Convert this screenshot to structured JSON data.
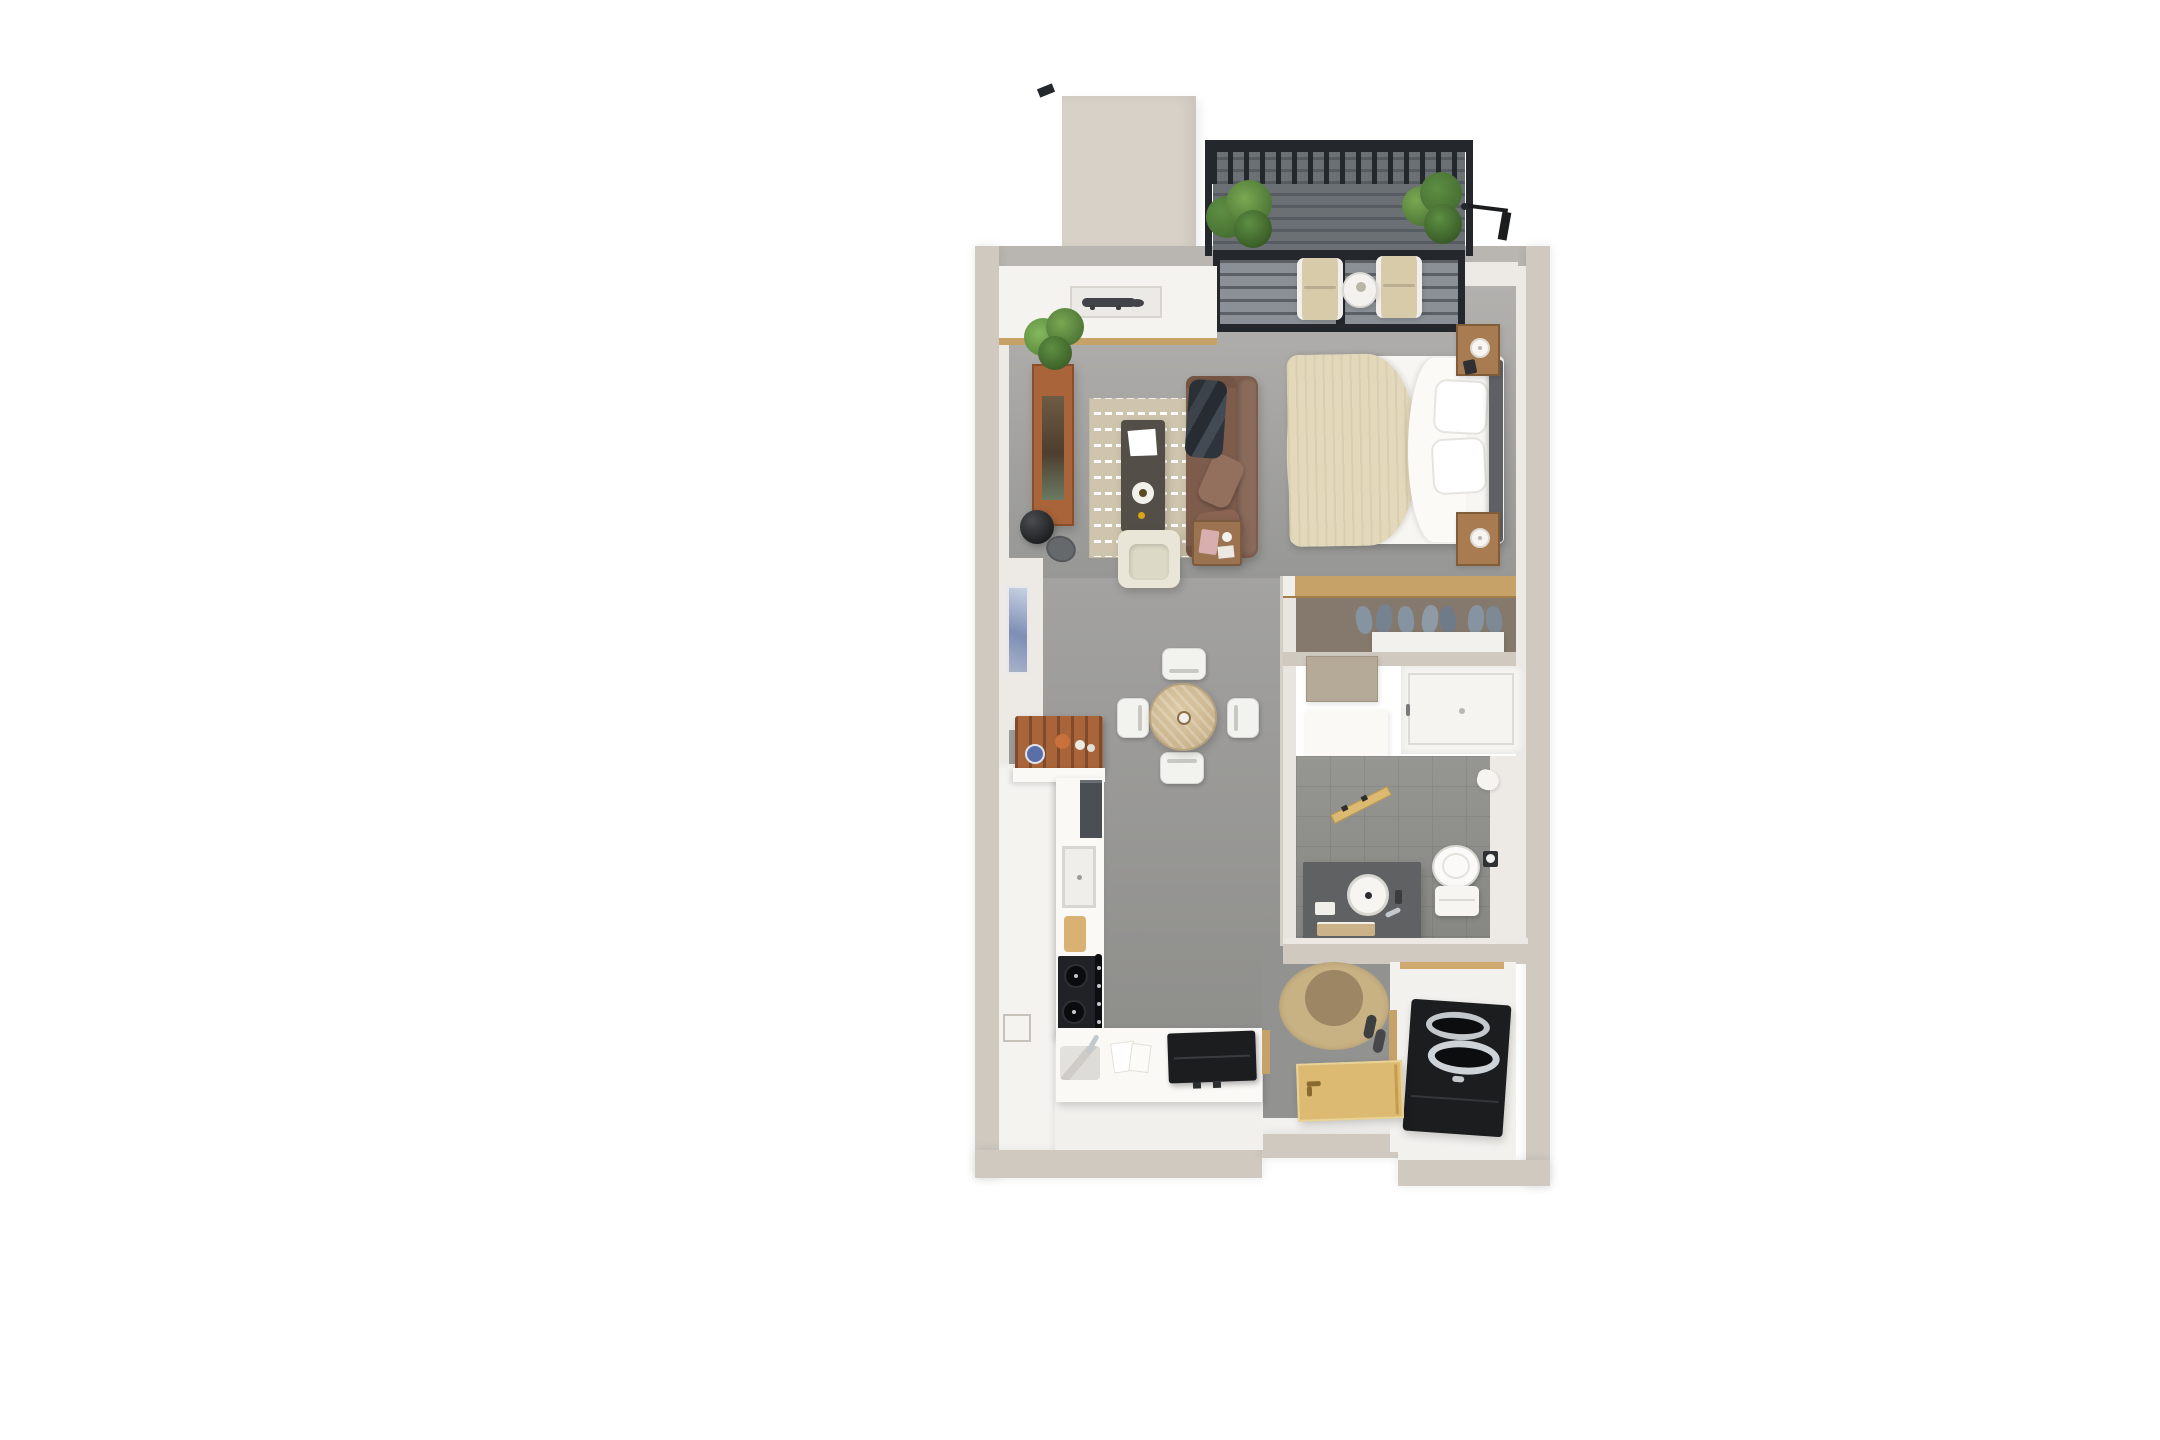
{
  "scene": {
    "view": "top-down-3d-floor-plan",
    "background": "#ffffff",
    "unit": "studio-apartment"
  },
  "palette": {
    "wall": "#cfc9c0",
    "wall-light": "#d7d1c8",
    "wall-face": "#edeae5",
    "top-wall": "#b9b6b1",
    "kitchen-white": "#f4f3f0",
    "counter-white": "#faf9f6",
    "closet-wood": "#c7a268",
    "closet-floor": "#84796c",
    "bath-tile": "#90908c",
    "shower-white": "#f5f4f1",
    "vanity-dark": "#5f6163",
    "wood": "#a9643a",
    "wood-dark": "#8a4e2b",
    "rug": "#cfc5ae",
    "sofa": "#7d5c4c",
    "sofa-light": "#8a6a59",
    "throw": "#33383f",
    "cream": "#e9e6d8",
    "table-wood": "#d2bd97",
    "duvet": "#e3d9ba",
    "sheet": "#f7f6f3",
    "headboard": "#5e6163",
    "nightstand": "#a87c50",
    "railing": "#24272b",
    "glass": "#8a9096",
    "plant-dark": "#3f652c",
    "plant-mid": "#5d8f43",
    "plant-light": "#79a852",
    "cushion": "#d8cba9",
    "jute": "#c8b183",
    "jute-center": "#9d8663",
    "door-wood": "#ddba72",
    "appliance-black": "#1b1d1f",
    "steel": "#c3c8cd",
    "art-blue": "#8fa3c8",
    "stove-black": "#212225",
    "fridge-dark": "#4b4e53",
    "board-wood": "#d9b173",
    "dresser": "#b5a997",
    "shelf-white": "#f2f1ee",
    "clothes": "#8693a0",
    "marble": "#d8d6d2",
    "towel": "#cbb289",
    "pink": "#d8aeae"
  },
  "areas": {
    "balcony": {
      "items": [
        "railing",
        "slatted-deck",
        "potted-plant-left",
        "potted-plant-right",
        "lounge-chair-left",
        "lounge-chair-right",
        "bistro-table",
        "exterior-lamp",
        "sliding-glass-door"
      ]
    },
    "living_room": {
      "items": [
        "white-console",
        "crocodile-sculpture",
        "media-console",
        "console-plant",
        "floor-lamp",
        "area-rug",
        "coffee-table",
        "leather-sofa",
        "throw-blanket",
        "side-table",
        "armchair",
        "cowhide-rug",
        "wall-art"
      ]
    },
    "bedroom": {
      "items": [
        "bed",
        "duvet",
        "pillows",
        "headboard",
        "nightstand-north",
        "nightstand-south",
        "table-lamps"
      ]
    },
    "dining": {
      "items": [
        "round-dining-table",
        "dining-chair-north",
        "dining-chair-south",
        "dining-chair-west",
        "dining-chair-east",
        "centerpiece"
      ]
    },
    "kitchen": {
      "items": [
        "plate-rack",
        "counter-run",
        "refrigerator-panel",
        "sink-recess",
        "cutting-board",
        "cooktop",
        "oven-handle",
        "peninsula-counter",
        "peninsula-sink",
        "faucet",
        "papers",
        "black-countertop-appliance",
        "niche-square"
      ]
    },
    "closet": {
      "items": [
        "wood-header",
        "hanging-clothes",
        "closet-shelf",
        "dresser",
        "linen-box"
      ]
    },
    "bathroom": {
      "items": [
        "shower",
        "bathroom-door",
        "vanity",
        "vessel-sink",
        "toilet",
        "toilet-paper-holder",
        "towel"
      ]
    },
    "laundry": {
      "items": [
        "washer-dryer-unit"
      ]
    },
    "entry": {
      "items": [
        "jute-rug",
        "slippers",
        "front-door",
        "threshold"
      ]
    },
    "exterior": {
      "items": [
        "chimney-block",
        "rail-fragment"
      ]
    }
  }
}
